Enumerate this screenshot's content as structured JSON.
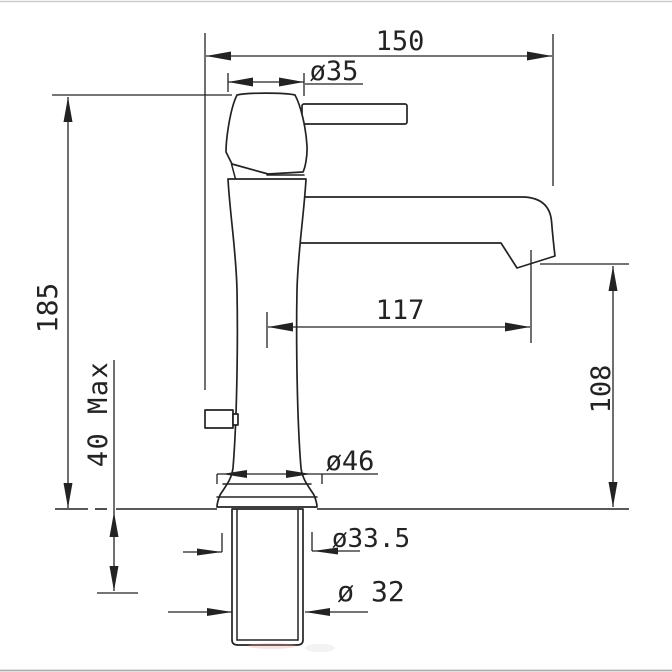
{
  "drawing": {
    "type": "technical-drawing",
    "subject": "single-lever basin faucet side elevation with installation dimensions (mm)",
    "labels": {
      "reach_overall": "150",
      "handle_diameter": "ø35",
      "height_overall": "185",
      "deck_max": "40 Max",
      "outlet_reach": "117",
      "outlet_height": "108",
      "base_diameter": "ø46",
      "hole_diameter": "ø33.5",
      "thread_diameter": "ø 32"
    },
    "colors": {
      "line": "#232323",
      "background": "#ffffff",
      "frame_top": "#cdcdcd",
      "frame_bottom": "#aeaeae"
    }
  }
}
